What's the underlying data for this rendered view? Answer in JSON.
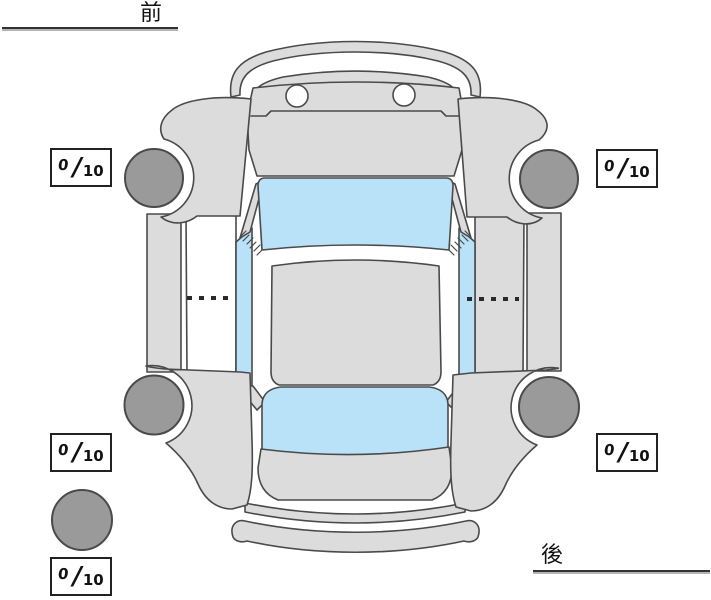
{
  "labels": {
    "front": "前",
    "rear": "後"
  },
  "score_separator": "/",
  "scores": {
    "front_left": {
      "value": "0",
      "max": "10"
    },
    "front_right": {
      "value": "0",
      "max": "10"
    },
    "rear_left": {
      "value": "0",
      "max": "10"
    },
    "rear_right": {
      "value": "0",
      "max": "10"
    },
    "spare": {
      "value": "0",
      "max": "10"
    }
  },
  "colors": {
    "background": "#ffffff",
    "car_body": "#dcdcdc",
    "glass": "#b9e1f8",
    "tire": "#9a9a9a",
    "outline": "#4a4a4a",
    "score_box_border": "#222222",
    "label_text": "#111111"
  }
}
